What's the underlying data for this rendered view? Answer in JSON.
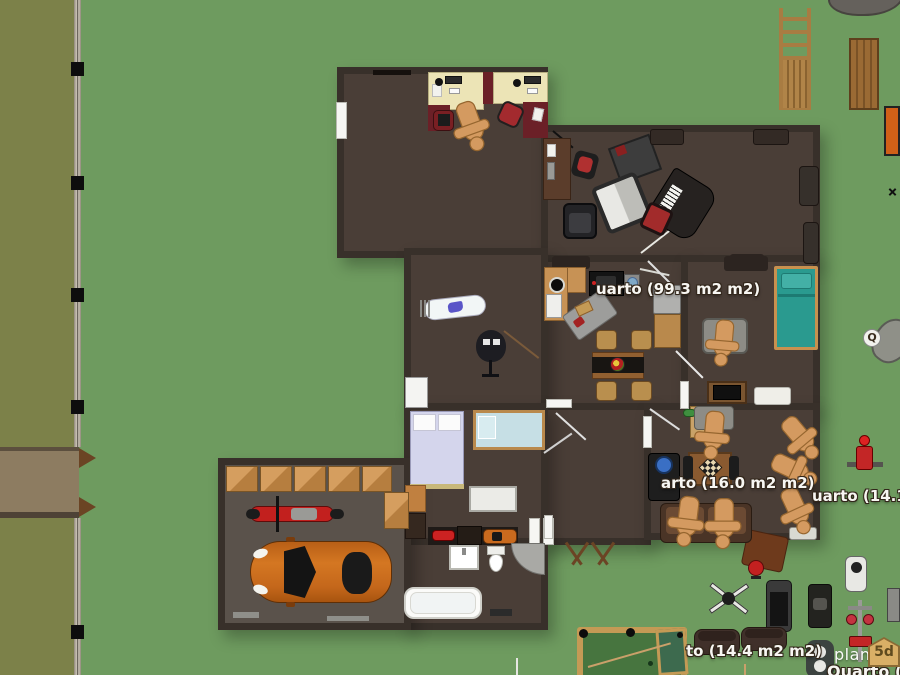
{
  "app": {
    "name": "planner5d-floorplan-editor",
    "watermark": {
      "text": "planner",
      "badge": "5d"
    }
  },
  "labels": {
    "room_99": "uarto (99.3 m2 m2)",
    "room_16": "arto (16.0 m2 m2)",
    "room_144": "to (14.4 m2 m2)",
    "room_141": "uarto (14.1 m2",
    "room_19": "Quarto (19",
    "q_marker": "Q"
  },
  "colors": {
    "lawn": "#6e9b5f",
    "olive_strip": "#7c8149",
    "road": "#8d7c61",
    "fence": "#b5ac9d",
    "wall": "#38302a",
    "floor": "#4a3e37",
    "garage_floor": "#5a524b",
    "desk_top": "#ece4b6",
    "accent_maroon": "#6b2027",
    "chair_red": "#a32a2e",
    "bed_teal": "#2a9a8f",
    "bed_lavender": "#d4d5ec",
    "car_orange": "#c4671b",
    "pool_felt": "#47753f",
    "wood_tan": "#c79255",
    "mannequin": "#d49a60",
    "label_text": "#f7f6f2"
  }
}
